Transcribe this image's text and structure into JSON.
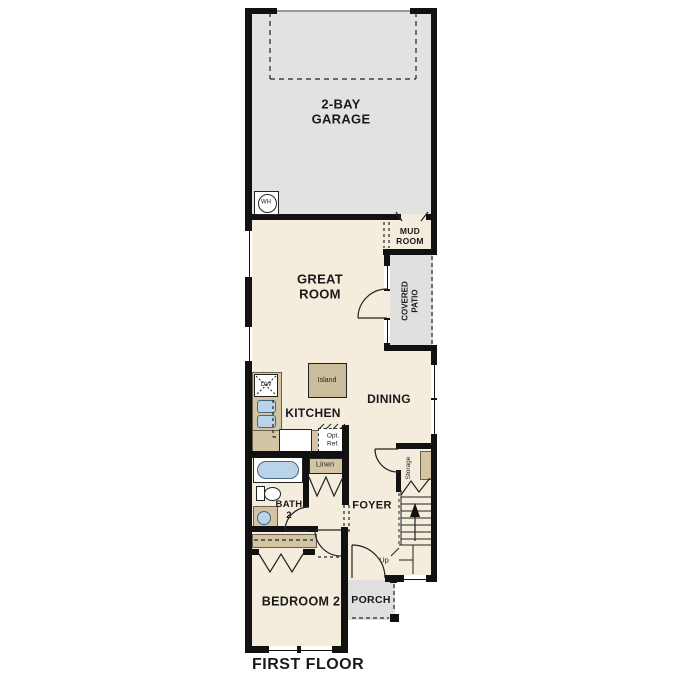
{
  "plan": {
    "type": "residential-floor-plan",
    "floor_title": "FIRST FLOOR",
    "labels": {
      "garage": "2-BAY\nGARAGE",
      "mud_room": "MUD\nROOM",
      "great_room": "GREAT\nROOM",
      "covered_patio": "COVERED\nPATIO",
      "island": "Island",
      "kitchen": "KITCHEN",
      "dining": "DINING",
      "dw": "DW",
      "opt_ref": "Opt.\nRef.",
      "linen": "Linen",
      "bath_2": "BATH\n2",
      "foyer": "FOYER",
      "storage": "Storage",
      "up": "Up",
      "bedroom_2": "BEDROOM 2",
      "porch": "PORCH",
      "water_heater": "WH",
      "first_floor": "FIRST FLOOR"
    },
    "colors": {
      "background": "#ffffff",
      "interior_floor": "#f4eddd",
      "garage_floor": "#e2e2e1",
      "patio_floor": "#e0e0df",
      "porch_floor": "#e0e0df",
      "cabinet_tan": "#d3c5a4",
      "island_tan": "#cbbc9c",
      "fixture_blue": "#b9d3e8",
      "wall": "#111111"
    }
  }
}
